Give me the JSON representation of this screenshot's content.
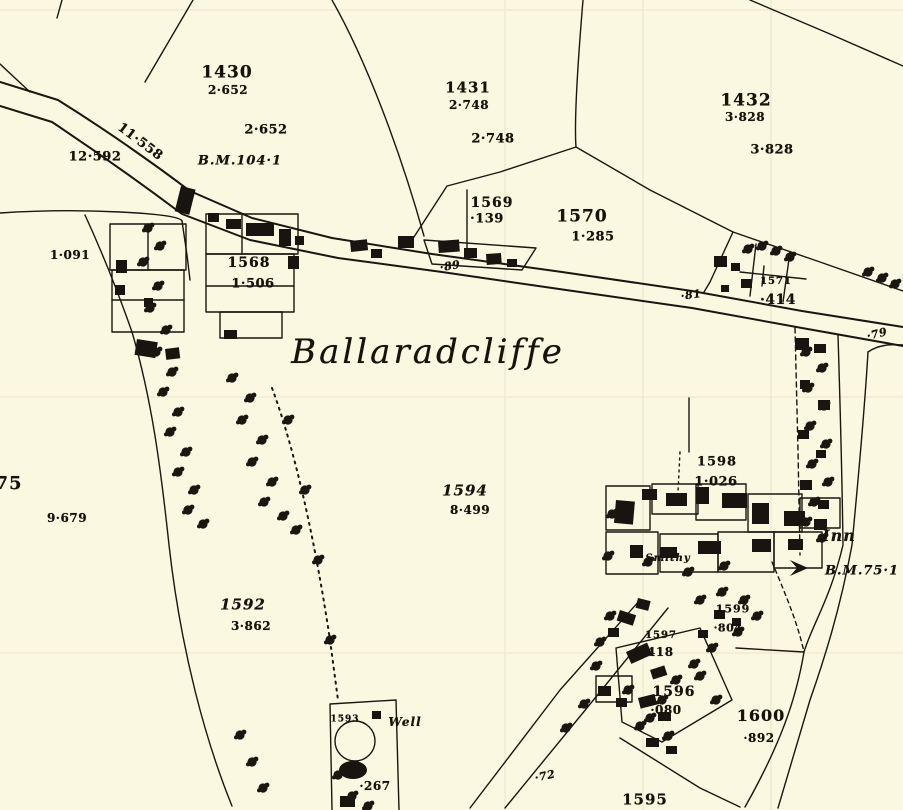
{
  "map": {
    "place_name": "Ballaradcliffe",
    "background_color": "#faf8e1",
    "ink_color": "#1a1610",
    "parcels": [
      {
        "number": "1430",
        "area": "2·652"
      },
      {
        "number": "1431",
        "area": "2·748"
      },
      {
        "number": "1432",
        "area": "3·828"
      },
      {
        "number": "1568",
        "area": "1·506"
      },
      {
        "number": "1569",
        "area": "·139"
      },
      {
        "number": "1570",
        "area": "1·285"
      },
      {
        "number": "1571",
        "area": "·414"
      },
      {
        "number": "75",
        "area": "9·679"
      },
      {
        "number": "1592",
        "area": "3·862"
      },
      {
        "number": "1593",
        "area": ""
      },
      {
        "number": "1594",
        "area": "8·499"
      },
      {
        "number": "1595",
        "area": ""
      },
      {
        "number": "1596",
        "area": "·080"
      },
      {
        "number": "1597",
        "area": "·418"
      },
      {
        "number": "1598",
        "area": "1·026"
      },
      {
        "number": "1599",
        "area": "·804"
      },
      {
        "number": "1600",
        "area": "·892"
      }
    ],
    "road_numbers": [
      "12·592",
      "11·558",
      "·89",
      "·81",
      "·79",
      "·72",
      "·267",
      "1·091"
    ],
    "bench_marks": [
      "B.M.104·1",
      "B.M.75·1"
    ],
    "features": [
      "Inn",
      "Well",
      "Smithy"
    ],
    "labels": [
      {
        "name": "parcel-1430-number",
        "text": "1430",
        "x": 227,
        "y": 73,
        "s": 17,
        "c": "num"
      },
      {
        "name": "parcel-1430-area",
        "text": "2·652",
        "x": 228,
        "y": 90,
        "s": 12,
        "c": "area"
      },
      {
        "name": "parcel-1430-area-repeat",
        "text": "2·652",
        "x": 266,
        "y": 130,
        "s": 13,
        "c": "area"
      },
      {
        "name": "road-area-12592",
        "text": "12·592",
        "x": 95,
        "y": 157,
        "s": 13,
        "c": "area"
      },
      {
        "name": "road-area-11558",
        "text": "11·558",
        "x": 140,
        "y": 142,
        "s": 13,
        "c": "area",
        "r": 37
      },
      {
        "name": "bench-mark-104-label",
        "text": "B.M.104·1",
        "x": 240,
        "y": 161,
        "s": 13,
        "c": "name"
      },
      {
        "name": "parcel-1431-number",
        "text": "1431",
        "x": 468,
        "y": 88,
        "s": 15,
        "c": "num"
      },
      {
        "name": "parcel-1431-area",
        "text": "2·748",
        "x": 469,
        "y": 105,
        "s": 12,
        "c": "area"
      },
      {
        "name": "parcel-1431-area-repeat",
        "text": "2·748",
        "x": 493,
        "y": 139,
        "s": 13,
        "c": "area"
      },
      {
        "name": "parcel-1432-number",
        "text": "1432",
        "x": 746,
        "y": 101,
        "s": 17,
        "c": "num"
      },
      {
        "name": "parcel-1432-area",
        "text": "3·828",
        "x": 745,
        "y": 117,
        "s": 12,
        "c": "area"
      },
      {
        "name": "parcel-1432-area-repeat",
        "text": "3·828",
        "x": 772,
        "y": 150,
        "s": 13,
        "c": "area"
      },
      {
        "name": "parcel-1569-number",
        "text": "1569",
        "x": 492,
        "y": 203,
        "s": 14,
        "c": "num"
      },
      {
        "name": "parcel-1569-area",
        "text": "·139",
        "x": 487,
        "y": 219,
        "s": 13,
        "c": "area"
      },
      {
        "name": "parcel-1570-number",
        "text": "1570",
        "x": 582,
        "y": 217,
        "s": 17,
        "c": "num"
      },
      {
        "name": "parcel-1570-area",
        "text": "1·285",
        "x": 593,
        "y": 237,
        "s": 13,
        "c": "area"
      },
      {
        "name": "road-number-89",
        "text": "·89",
        "x": 450,
        "y": 266,
        "s": 11,
        "c": "area ital",
        "r": -10
      },
      {
        "name": "road-number-81",
        "text": "·81",
        "x": 691,
        "y": 295,
        "s": 11,
        "c": "area ital",
        "r": -8
      },
      {
        "name": "parcel-1571-number",
        "text": "1571",
        "x": 776,
        "y": 282,
        "s": 10,
        "c": "num"
      },
      {
        "name": "parcel-1571-area",
        "text": "·414",
        "x": 778,
        "y": 300,
        "s": 14,
        "c": "area"
      },
      {
        "name": "road-number-79",
        "text": "·79",
        "x": 877,
        "y": 334,
        "s": 11,
        "c": "area ital",
        "r": -14
      },
      {
        "name": "parcel-area-1091",
        "text": "1·091",
        "x": 70,
        "y": 255,
        "s": 12,
        "c": "area"
      },
      {
        "name": "parcel-1568-number",
        "text": "1568",
        "x": 249,
        "y": 263,
        "s": 14,
        "c": "num"
      },
      {
        "name": "parcel-1568-area",
        "text": "1·506",
        "x": 253,
        "y": 284,
        "s": 13,
        "c": "area"
      },
      {
        "name": "place-name-label",
        "text": "Ballaradcliffe",
        "x": 428,
        "y": 352,
        "s": 34,
        "c": "place"
      },
      {
        "name": "parcel-75-number",
        "text": "75",
        "x": 9,
        "y": 484,
        "s": 18,
        "c": "num"
      },
      {
        "name": "parcel-75-area",
        "text": "9·679",
        "x": 67,
        "y": 518,
        "s": 12,
        "c": "area"
      },
      {
        "name": "parcel-1594-number",
        "text": "1594",
        "x": 465,
        "y": 491,
        "s": 15,
        "c": "num ital"
      },
      {
        "name": "parcel-1594-area",
        "text": "8·499",
        "x": 470,
        "y": 510,
        "s": 12,
        "c": "area"
      },
      {
        "name": "parcel-1592-number",
        "text": "1592",
        "x": 243,
        "y": 605,
        "s": 15,
        "c": "num ital"
      },
      {
        "name": "parcel-1592-area",
        "text": "3·862",
        "x": 251,
        "y": 626,
        "s": 12,
        "c": "area"
      },
      {
        "name": "parcel-1598-number",
        "text": "1598",
        "x": 717,
        "y": 462,
        "s": 13,
        "c": "num"
      },
      {
        "name": "parcel-1598-area",
        "text": "1·026",
        "x": 716,
        "y": 482,
        "s": 13,
        "c": "area"
      },
      {
        "name": "inn-label",
        "text": "Inn",
        "x": 839,
        "y": 536,
        "s": 16,
        "c": "name"
      },
      {
        "name": "bench-mark-75-label",
        "text": "B.M.75·1",
        "x": 862,
        "y": 571,
        "s": 13,
        "c": "name"
      },
      {
        "name": "smithy-label",
        "text": "Smithy",
        "x": 668,
        "y": 559,
        "s": 10,
        "c": "name"
      },
      {
        "name": "parcel-1599-number",
        "text": "1599",
        "x": 733,
        "y": 609,
        "s": 11,
        "c": "num"
      },
      {
        "name": "parcel-1599-area",
        "text": "·804",
        "x": 728,
        "y": 628,
        "s": 11,
        "c": "area"
      },
      {
        "name": "parcel-1597-number",
        "text": "1597",
        "x": 661,
        "y": 636,
        "s": 10,
        "c": "num"
      },
      {
        "name": "parcel-1597-area",
        "text": "·418",
        "x": 658,
        "y": 652,
        "s": 12,
        "c": "area"
      },
      {
        "name": "parcel-1596-number",
        "text": "1596",
        "x": 674,
        "y": 692,
        "s": 14,
        "c": "num"
      },
      {
        "name": "parcel-1596-area",
        "text": "·080",
        "x": 666,
        "y": 710,
        "s": 12,
        "c": "area"
      },
      {
        "name": "parcel-1600-number",
        "text": "1600",
        "x": 761,
        "y": 716,
        "s": 16,
        "c": "num"
      },
      {
        "name": "parcel-1600-area",
        "text": "·892",
        "x": 759,
        "y": 738,
        "s": 12,
        "c": "area"
      },
      {
        "name": "parcel-1595-number",
        "text": "1595",
        "x": 645,
        "y": 800,
        "s": 15,
        "c": "num"
      },
      {
        "name": "parcel-1593-number",
        "text": "1593",
        "x": 345,
        "y": 720,
        "s": 9,
        "c": "num"
      },
      {
        "name": "well-label",
        "text": "Well",
        "x": 405,
        "y": 722,
        "s": 12,
        "c": "name"
      },
      {
        "name": "well-area-267",
        "text": "·267",
        "x": 375,
        "y": 786,
        "s": 12,
        "c": "area"
      },
      {
        "name": "road-number-72",
        "text": "·72",
        "x": 545,
        "y": 776,
        "s": 11,
        "c": "area ital",
        "r": -12
      }
    ]
  }
}
